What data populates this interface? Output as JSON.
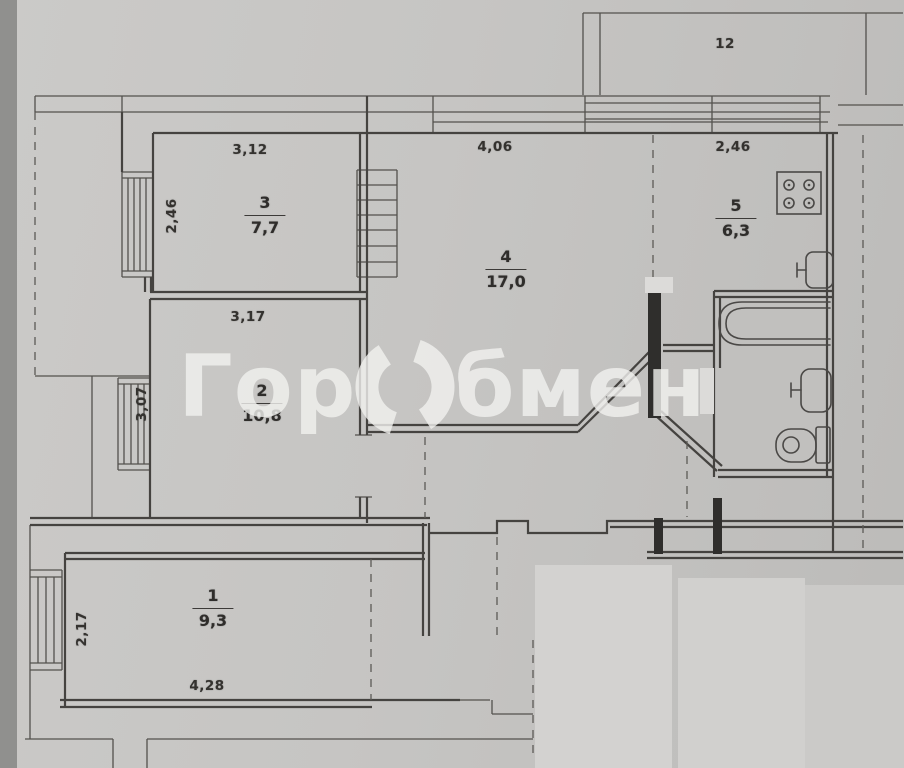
{
  "watermark": {
    "prefix": "Гор",
    "suffix": "бмен"
  },
  "balcony": {
    "label": "12"
  },
  "rooms": [
    {
      "number": "3",
      "area": "7,7",
      "dim_top": "3,12",
      "dim_left": "2,46"
    },
    {
      "number": "4",
      "area": "17,0",
      "dim_top": "4,06"
    },
    {
      "number": "5",
      "area": "6,3",
      "dim_top": "2,46"
    },
    {
      "number": "2",
      "area": "10,8",
      "dim_top": "3,17",
      "dim_left": "3,07"
    },
    {
      "number": "1",
      "area": "9,3",
      "dim_bottom": "4,28",
      "dim_left": "2,17"
    }
  ],
  "fixtures": {
    "bathtub": "bathtub-icon",
    "bath_sink": "sink-icon",
    "toilet": "toilet-icon",
    "stove": "stove-icon",
    "kitchen_sink": "sink-icon"
  },
  "colors": {
    "paper": "#c6c5c3",
    "scan_edge": "#90908e",
    "line": "#454340",
    "erased_patch": "#d3d2d0",
    "watermark": "rgba(241,241,239,0.8)"
  }
}
